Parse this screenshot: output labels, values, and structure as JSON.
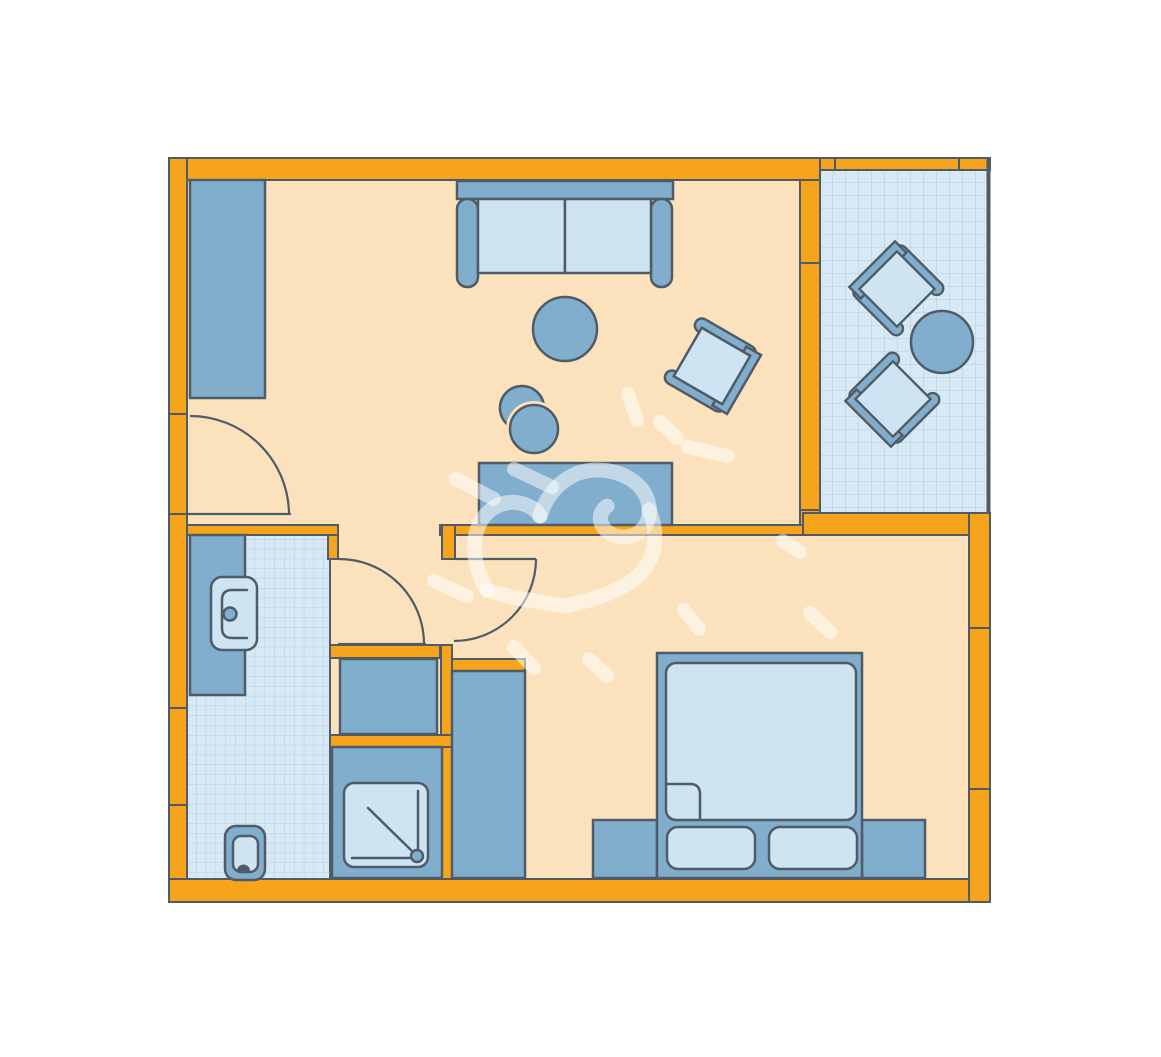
{
  "title": "Apartment floor plan",
  "colors": {
    "paper": "#FFFFFF",
    "wall": "#F6A41C",
    "outline": "#4F5B66",
    "floor": "#FBE2BC",
    "furniture": "#82AECE",
    "furniture_light": "#CFE4F3",
    "tile": "#D7E9F5",
    "tile_grid": "#AFD0E4",
    "watermark": "rgba(255,255,255,0.52)"
  },
  "rooms": [
    {
      "name": "living-room",
      "floor": "plain",
      "furniture": [
        "wardrobe",
        "sofa",
        "coffee-table",
        "desk",
        "desk-stools",
        "armchair"
      ]
    },
    {
      "name": "balcony",
      "floor": "tiled",
      "furniture": [
        "lounge-chair",
        "lounge-chair",
        "round-table"
      ]
    },
    {
      "name": "bathroom",
      "floor": "tiled",
      "furniture": [
        "vanity-with-sink",
        "toilet",
        "shower"
      ]
    },
    {
      "name": "hallway",
      "floor": "plain",
      "furniture": [
        "closet",
        "wardrobe"
      ]
    },
    {
      "name": "bedroom",
      "floor": "plain",
      "furniture": [
        "double-bed",
        "pillow",
        "pillow",
        "nightstand",
        "nightstand"
      ]
    }
  ],
  "doors": [
    "entry-door",
    "bathroom-door",
    "bedroom-door"
  ],
  "watermark": "hand-drawn heart doodle with radiating dashes"
}
